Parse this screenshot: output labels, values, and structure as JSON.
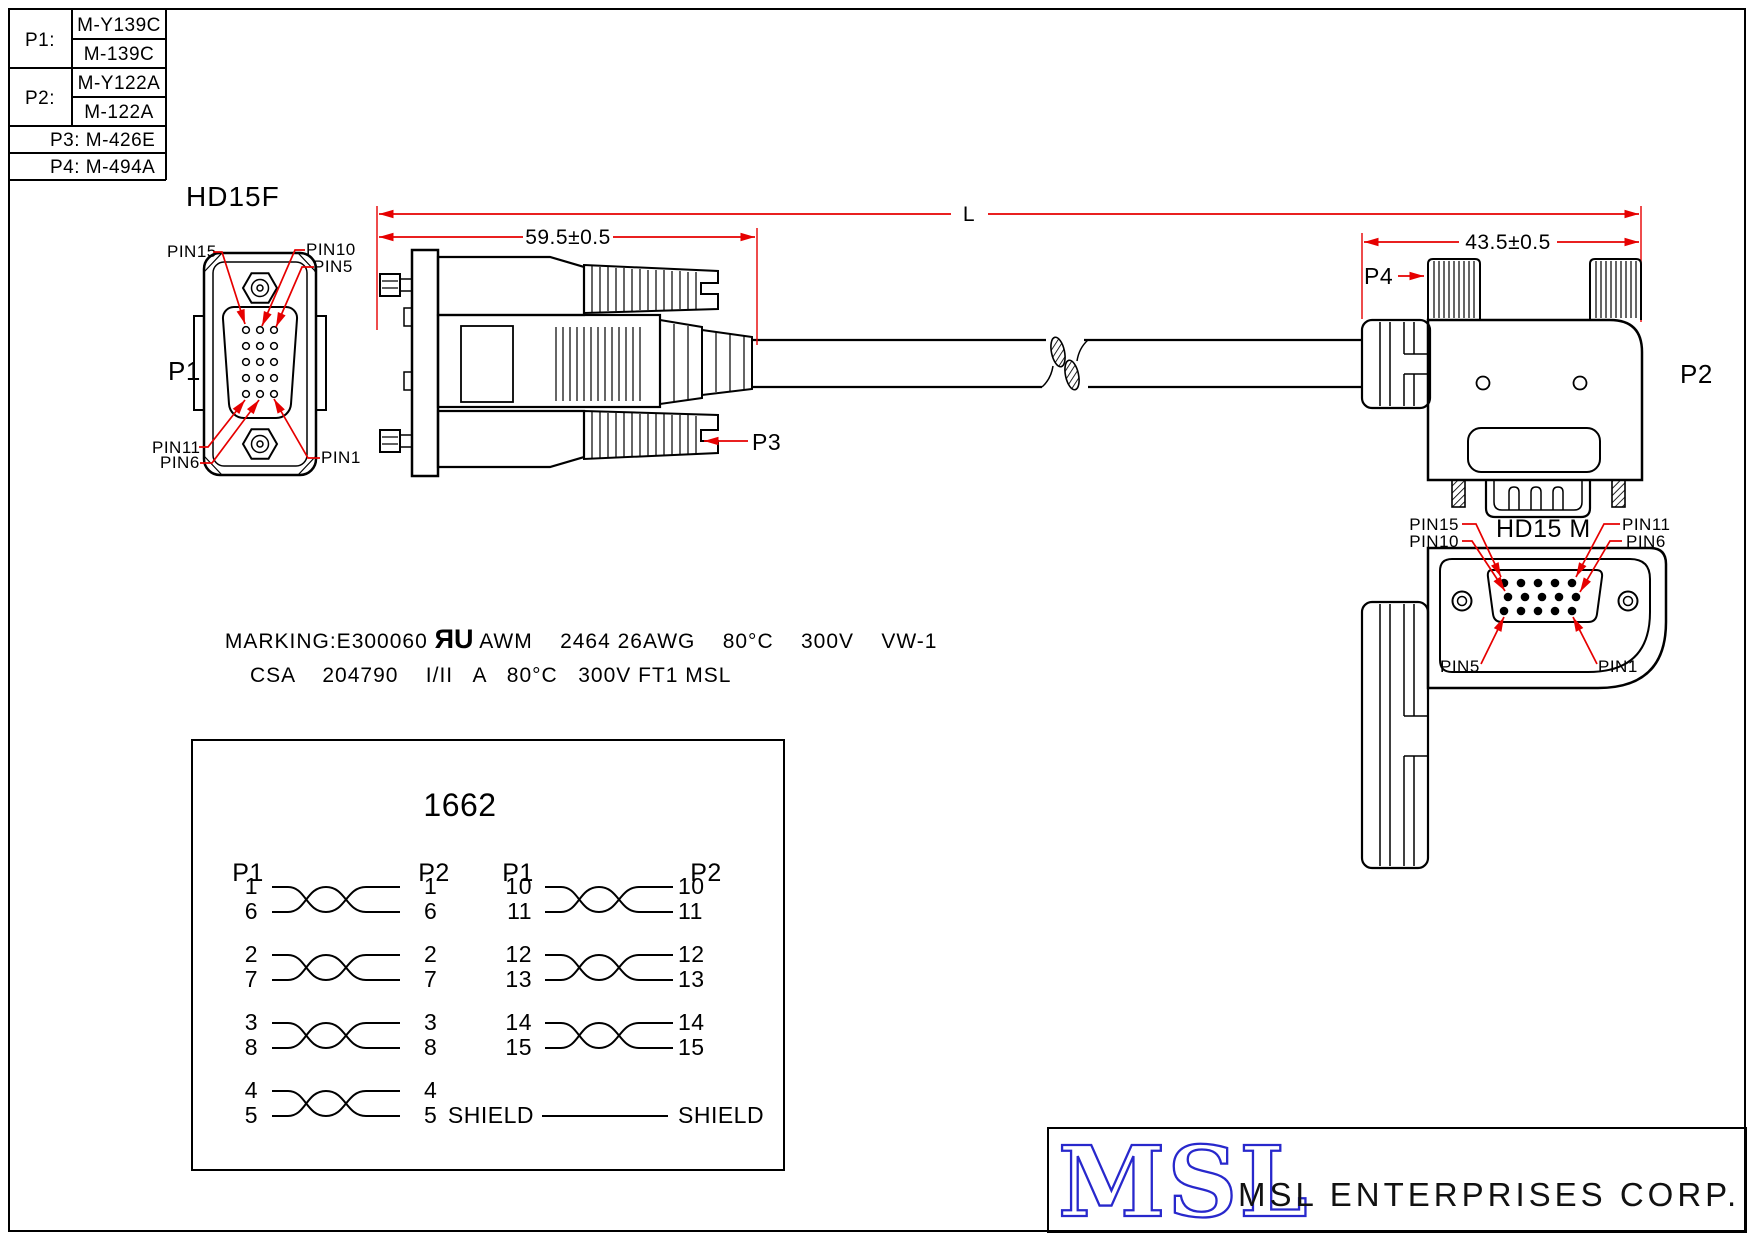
{
  "colors": {
    "line": "#000000",
    "annotation_red": "#e60000",
    "logo_blue": "#2828cc"
  },
  "parts_table": {
    "rows": [
      {
        "label": "P1:",
        "v1": "M-Y139C",
        "v2": "M-139C"
      },
      {
        "label": "P2:",
        "v1": "M-Y122A",
        "v2": "M-122A"
      }
    ],
    "singles": [
      "P3: M-426E",
      "P4: M-494A"
    ]
  },
  "hd15f": {
    "title": "HD15F",
    "designator": "P1",
    "pin15": "PIN15",
    "pin10": "PIN10",
    "pin5": "PIN5",
    "pin11": "PIN11",
    "pin6": "PIN6",
    "pin1": "PIN1"
  },
  "dims": {
    "overall": "L",
    "p1_side": "59.5±0.5",
    "p2_side": "43.5±0.5"
  },
  "callouts": {
    "p2": "P2",
    "p3": "P3",
    "p4": "P4"
  },
  "hd15m": {
    "title": "HD15 M",
    "pin15": "PIN15",
    "pin10": "PIN10",
    "pin11": "PIN11",
    "pin6": "PIN6",
    "pin5": "PIN5",
    "pin1": "PIN1"
  },
  "marking": {
    "prefix": "MARKING:E300060 ",
    "ul": "ЯU",
    "line1": " AWM    2464 26AWG    80°C    300V    VW-1",
    "line2": "CSA    204790    I/II   A   80°C   300V FT1 MSL"
  },
  "wiring": {
    "part_number": "1662",
    "headers": [
      "P1",
      "P2",
      "P1",
      "P2"
    ],
    "pairs_left": [
      {
        "a": "1",
        "b": "6"
      },
      {
        "a": "2",
        "b": "7"
      },
      {
        "a": "3",
        "b": "8"
      },
      {
        "a": "4",
        "b": "5"
      }
    ],
    "pairs_right": [
      {
        "a": "10",
        "b": "11"
      },
      {
        "a": "12",
        "b": "13"
      },
      {
        "a": "14",
        "b": "15"
      }
    ],
    "shield": "SHIELD"
  },
  "footer": {
    "logo": "MSL",
    "company": "MSL ENTERPRISES CORP."
  }
}
